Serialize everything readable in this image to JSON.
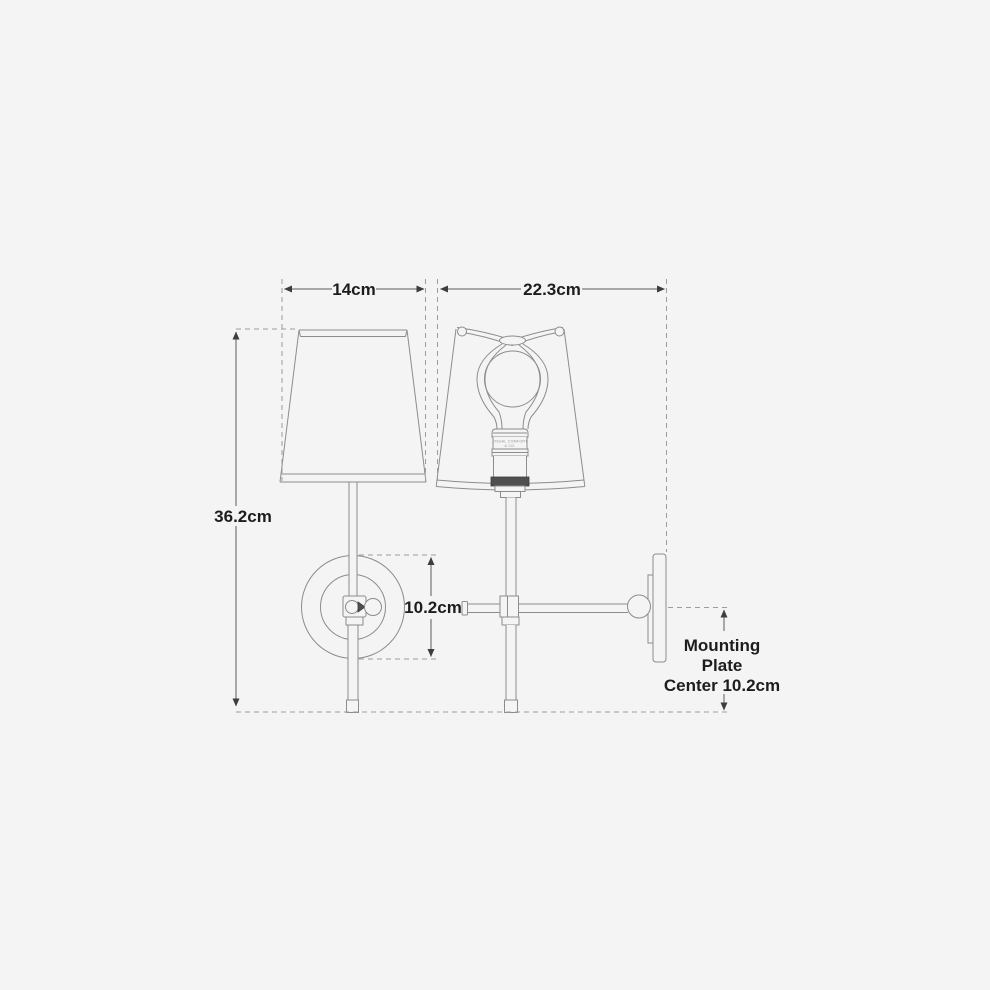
{
  "colors": {
    "background": "#f4f4f4",
    "object_line": "#8c8c8c",
    "dimension_line": "#5a5a5a",
    "dashed_line": "#9d9d9d",
    "text": "#1d1d1d",
    "knurl_band": "#4f4f4f"
  },
  "labels": {
    "shade_width": "14cm",
    "depth": "22.3cm",
    "overall_height": "36.2cm",
    "backplate_diameter": "10.2cm",
    "mounting_plate_note": {
      "line1": "Mounting",
      "line2": "Plate",
      "line3": "Center 10.2cm"
    },
    "socket_engraving": {
      "line1": "VISUAL COMFORT",
      "line2": "& CO."
    }
  }
}
